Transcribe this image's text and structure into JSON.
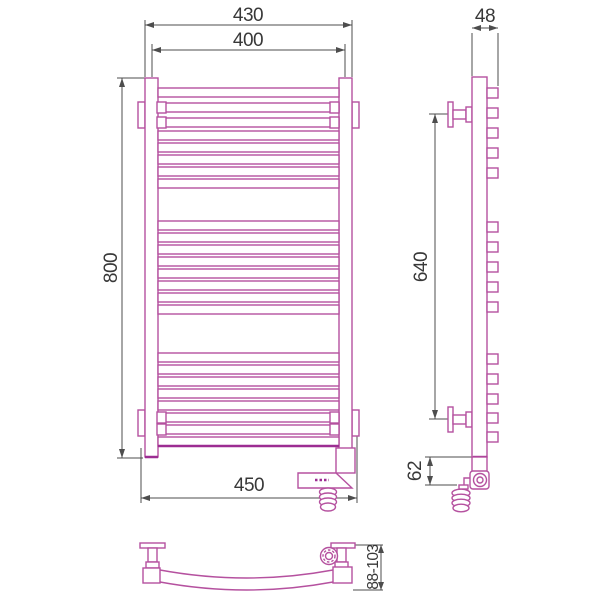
{
  "document": {
    "type": "technical dimension drawing",
    "subject": "ladder heated towel rail with wall brackets and electric heating element, shown in front, side and bottom orthographic views"
  },
  "views": {
    "front": {
      "dims": {
        "width_overall": "430",
        "width_centers": "400",
        "height": "800",
        "width_bottom": "450"
      }
    },
    "side": {
      "dims": {
        "depth": "48",
        "bracket_spacing": "640",
        "heater_offset": "62"
      }
    },
    "bottom": {
      "dims": {
        "wall_distance": "88-103"
      }
    }
  },
  "colors": {
    "object": "#b5519f",
    "object_dark": "#9c2d92",
    "dimension_line": "#4d4d4d",
    "dimension_text": "#383838",
    "background": "#ffffff"
  }
}
